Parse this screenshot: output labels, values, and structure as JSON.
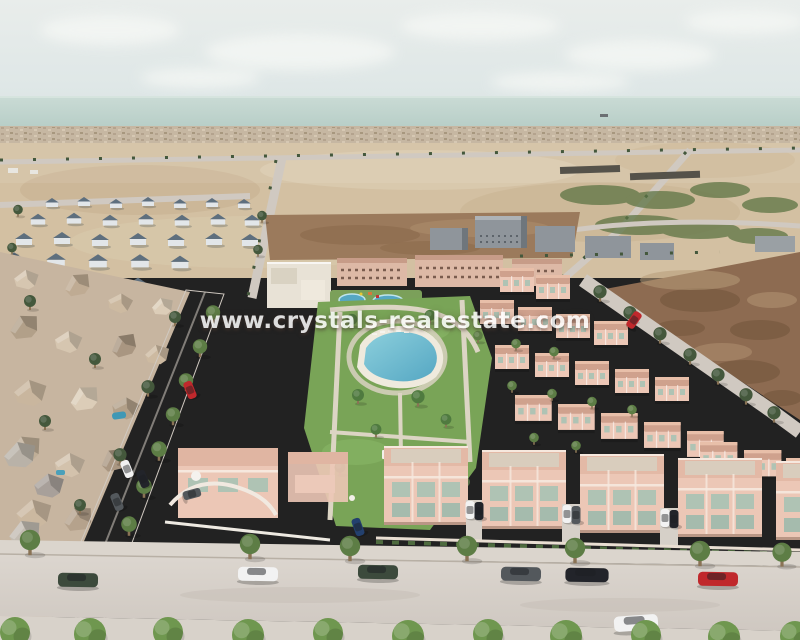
{
  "watermark": {
    "text": "www.crystals-realestate.com"
  },
  "scene": {
    "description": "Aerial 3D architectural rendering of a coastal residential development: rows of pink townhouses around a central park with a lagoon-style pool, an older beige neighborhood on the left, sandy plots, tree-lined streets with parked cars, and the sea on the horizon"
  },
  "colors": {
    "sky_top": "#e9edeb",
    "sky_bottom": "#dde6e6",
    "sea": "#b6cdc6",
    "coast": "#c6b7a2",
    "sand": "#d3c0a2",
    "soil": "#9b7a5c",
    "scrub": "#8d6b51",
    "road": "#d0c9c1",
    "street": "#cfc8c1",
    "old_town": "#c7b5a0",
    "white_complex": "#e8e2d6",
    "apartment": "#ddb9a6",
    "dev_wall": "#ecc7b6",
    "dev_roof": "#cfa18d",
    "grey_house_wall": "#e2e6e9",
    "grey_house_roof": "#5e6f7e",
    "grey_building": "#8f959b",
    "lawn": "#79a457",
    "pool": "#55a7c3",
    "pool_light": "#8ccfdc",
    "tree": "#5d7d45",
    "tree_dark": "#44583c",
    "bush": "#6f974f",
    "palm": "#4f7a3f",
    "watermark_text": "#ffffff",
    "car_white": "#f2f2f2",
    "car_black": "#22242a",
    "car_dark_green": "#3c4a3c",
    "car_red": "#c0282c",
    "car_grey": "#53585c",
    "car_blue": "#23406e"
  }
}
